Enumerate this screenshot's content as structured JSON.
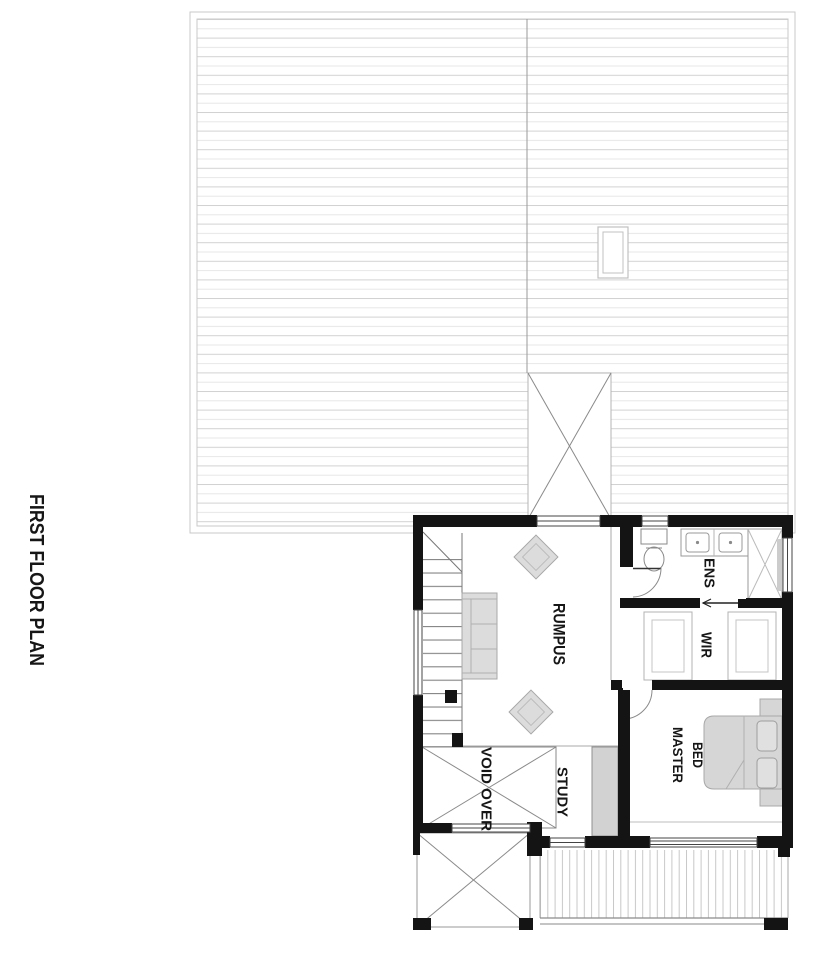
{
  "title": "FIRST FLOOR PLAN",
  "labels": {
    "rumpus": "RUMPUS",
    "ens": "ENS",
    "wir": "WIR",
    "master_bed_line1": "MASTER",
    "master_bed_line2": "BED",
    "study": "STUDY",
    "void_over": "VOID OVER"
  },
  "colors": {
    "wall_black": "#141414",
    "window_line": "#444444",
    "line_mid": "#8a8a8a",
    "line_light": "#cfcfcf",
    "furniture_fill": "#d9d9d9",
    "roof_line_dark": "#d2d2d2",
    "roof_line_light": "#e7e7e7",
    "background": "#ffffff",
    "text": "#161616"
  },
  "fixtures": [
    "roof-sheeting",
    "skylight",
    "roof-void-cross",
    "staircase",
    "sofa",
    "armchair",
    "armchair",
    "toilet",
    "vanity-double-basin",
    "shower",
    "wardrobe",
    "wardrobe",
    "sliding-door",
    "hinged-door",
    "hinged-door",
    "double-bed",
    "bedside-table",
    "bedside-table",
    "desk",
    "void-over-cross",
    "entry-void-cross",
    "deck-boards",
    "window",
    "window",
    "window",
    "window",
    "window",
    "window",
    "window"
  ]
}
